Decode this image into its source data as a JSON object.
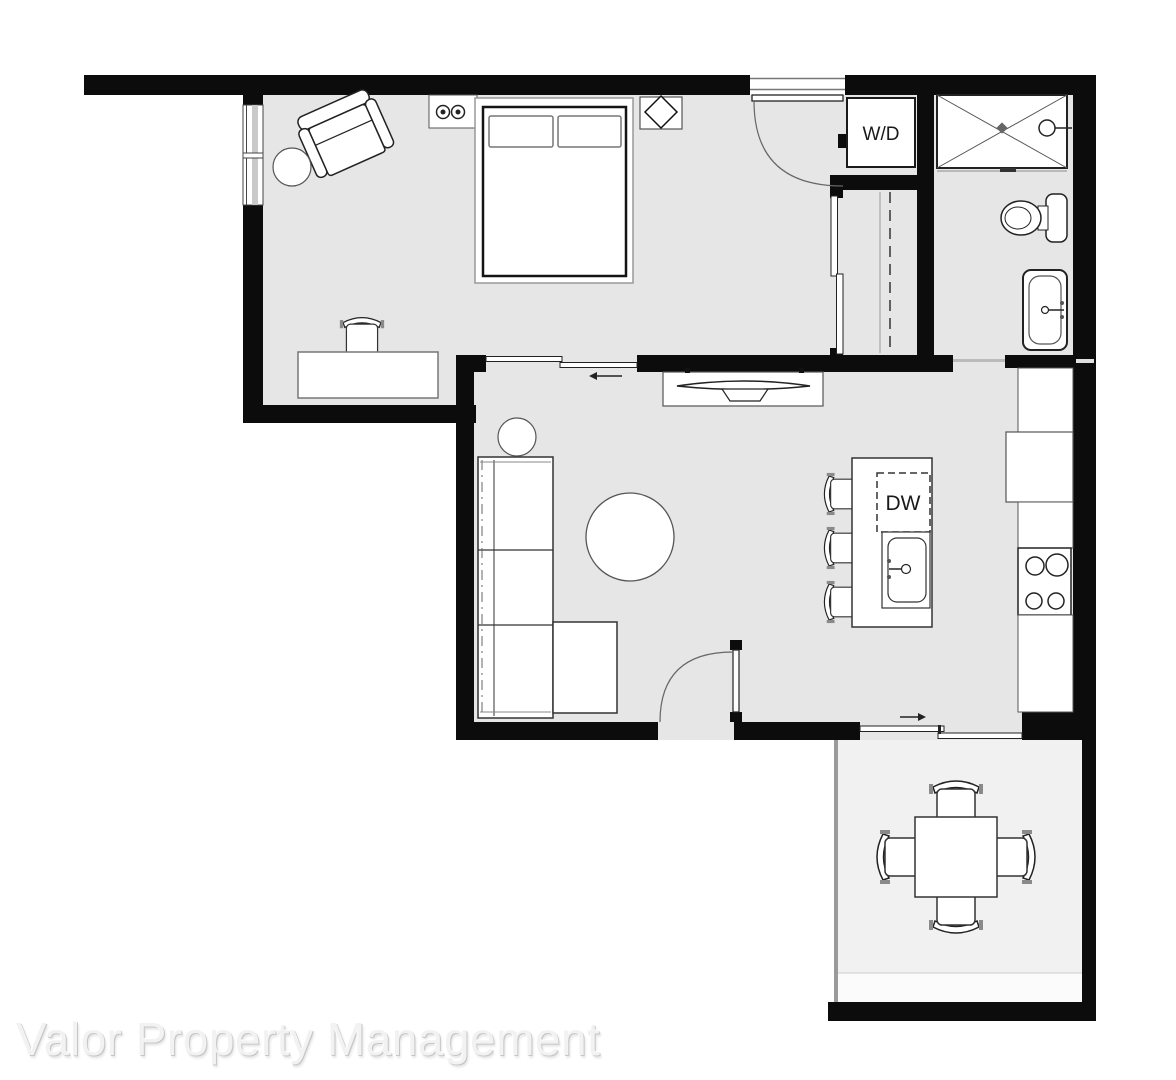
{
  "watermark": {
    "text": "Valor Property Management"
  },
  "labels": {
    "washer_dryer": "W/D",
    "dishwasher": "DW"
  },
  "colors": {
    "wall": "#0c0c0c",
    "floor": "#e6e6e6",
    "patio-floor": "#f1f1f1",
    "line-dark": "#222222",
    "line-mid": "#555555",
    "line-light": "#999999",
    "wm-fill": "#f2f2f2",
    "wm-shadow": "#c6c6c6",
    "wm-light": "#ffffff"
  },
  "fixtures": [
    "bed",
    "pillow",
    "outlet-symbols",
    "nightstand-lamp",
    "armchair",
    "round-side-table",
    "desk",
    "desk-chair",
    "window",
    "bedroom-door",
    "sliding-door",
    "slide-arrow-left",
    "washer-dryer",
    "closet-rod",
    "shower",
    "toilet",
    "vanity-sink",
    "tv-console",
    "sectional-sofa",
    "coffee-table",
    "entry-door",
    "kitchen-island",
    "dishwasher",
    "island-sink",
    "bar-stool",
    "refrigerator",
    "stove",
    "kitchen-counter",
    "patio-sliding-door",
    "slide-arrow-right",
    "patio-table",
    "patio-chair"
  ]
}
